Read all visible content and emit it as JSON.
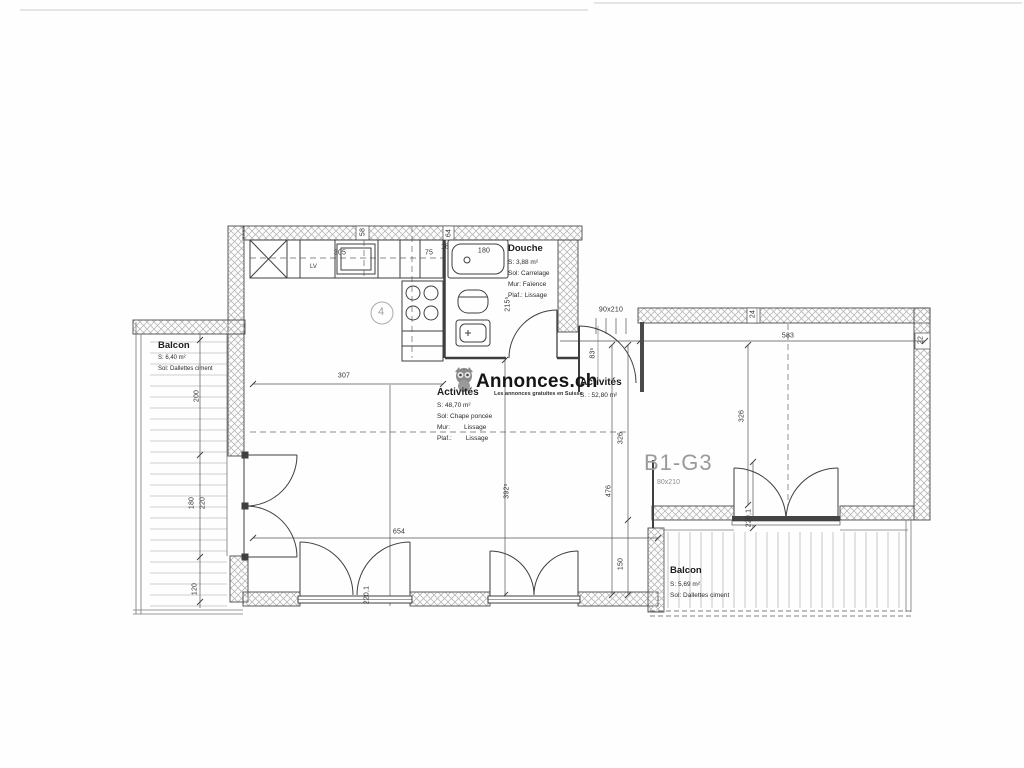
{
  "watermark": {
    "brand": "Annonces.ch",
    "tagline": "Les annonces gratuites en Suisse",
    "owl_icon": "owl-icon"
  },
  "unit_label": {
    "name": "B1-G3",
    "door_size": "80x210"
  },
  "rooms": {
    "douche": {
      "title": "Douche",
      "area": "S: 3,88 m²",
      "sol": "Sol: Carrelage",
      "mur": "Mur:  Faïence",
      "plaf": "Plaf.: Lissage"
    },
    "activites": {
      "title": "Activités",
      "area": "S: 48,70 m²",
      "sol": "Sol: Chape poncée",
      "mur_label": "Mur:",
      "mur_value": "Lissage",
      "plaf_label": "Plaf.:",
      "plaf_value": "Lissage"
    },
    "activites_est": {
      "title": "Activités",
      "area": "S. : 52,80 m²"
    },
    "balcon_ouest": {
      "title": "Balcon",
      "area": "S: 6,40 m²",
      "sol": "Sol: Dallettes ciment"
    },
    "balcon_sud": {
      "title": "Balcon",
      "area": "S: 5,69 m²",
      "sol": "Sol: Dallettes ciment"
    }
  },
  "kitchen": {
    "dishwasher": "LV"
  },
  "grid_marker": "4",
  "colors": {
    "line": "#3f3f3f",
    "hatch": "#b8b8b8",
    "dim_text": "#333333",
    "unit_label": "#9a9a9a"
  },
  "dimensions": [
    {
      "t": "307",
      "x": 344,
      "y": 376,
      "r": 0
    },
    {
      "t": "654",
      "x": 399,
      "y": 532,
      "r": 0
    },
    {
      "t": "583",
      "x": 788,
      "y": 336,
      "r": 0
    },
    {
      "t": "58",
      "x": 363,
      "y": 232,
      "r": 1
    },
    {
      "t": "64",
      "x": 449,
      "y": 233,
      "r": 1
    },
    {
      "t": "18",
      "x": 445,
      "y": 247,
      "r": 0
    },
    {
      "t": "305",
      "x": 340,
      "y": 253,
      "r": 0
    },
    {
      "t": "75",
      "x": 429,
      "y": 253,
      "r": 0
    },
    {
      "t": "180",
      "x": 484,
      "y": 251,
      "r": 0
    },
    {
      "t": "215⁵",
      "x": 508,
      "y": 304,
      "r": 1
    },
    {
      "t": "83⁵",
      "x": 593,
      "y": 353,
      "r": 1
    },
    {
      "t": "90x210",
      "x": 611,
      "y": 310,
      "r": 0
    },
    {
      "t": "24",
      "x": 753,
      "y": 314,
      "r": 1
    },
    {
      "t": "22",
      "x": 921,
      "y": 340,
      "r": 1
    },
    {
      "t": "326",
      "x": 742,
      "y": 416,
      "r": 1
    },
    {
      "t": "326",
      "x": 621,
      "y": 438,
      "r": 1
    },
    {
      "t": "476",
      "x": 609,
      "y": 491,
      "r": 1
    },
    {
      "t": "150",
      "x": 621,
      "y": 564,
      "r": 1
    },
    {
      "t": "392⁵",
      "x": 507,
      "y": 491,
      "r": 1
    },
    {
      "t": "220,1",
      "x": 749,
      "y": 518,
      "r": 1
    },
    {
      "t": "220,1",
      "x": 367,
      "y": 595,
      "r": 1
    },
    {
      "t": "200",
      "x": 197,
      "y": 396,
      "r": 1
    },
    {
      "t": "180",
      "x": 192,
      "y": 503,
      "r": 1
    },
    {
      "t": "220",
      "x": 203,
      "y": 503,
      "r": 1
    },
    {
      "t": "120",
      "x": 195,
      "y": 589,
      "r": 1
    }
  ]
}
